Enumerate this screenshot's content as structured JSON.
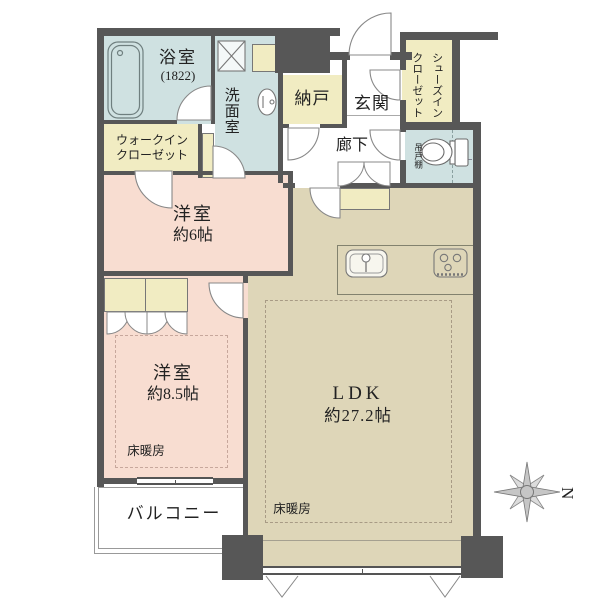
{
  "rooms": {
    "bathroom": {
      "label": "浴室",
      "size": "(1822)"
    },
    "washroom": {
      "label": "洗面室"
    },
    "walk_in_closet": {
      "line1": "ウォークイン",
      "line2": "クローゼット"
    },
    "storage": {
      "label": "納戸"
    },
    "entrance": {
      "label": "玄関"
    },
    "hallway": {
      "label": "廊下"
    },
    "shoes_in_closet": {
      "line1": "シューズイン",
      "line2": "クローゼット"
    },
    "hanging_cupboard": {
      "label": "吊戸棚"
    },
    "bedroom_6": {
      "label": "洋室",
      "size": "約6帖"
    },
    "bedroom_8_5": {
      "label": "洋室",
      "size": "約8.5帖"
    },
    "ldk": {
      "label": "LDK",
      "size": "約27.2帖"
    },
    "balcony": {
      "label": "バルコニー"
    }
  },
  "floor_heating": {
    "label": "床暖房"
  },
  "compass": {
    "north": "N"
  },
  "colors": {
    "wall": "#575757",
    "bedroom": "#f8ddd1",
    "ldk": "#ded6b8",
    "wet_area": "#cfe1e1",
    "closet": "#f1ecc2",
    "balcony_line": "#999999",
    "background": "#ffffff"
  }
}
